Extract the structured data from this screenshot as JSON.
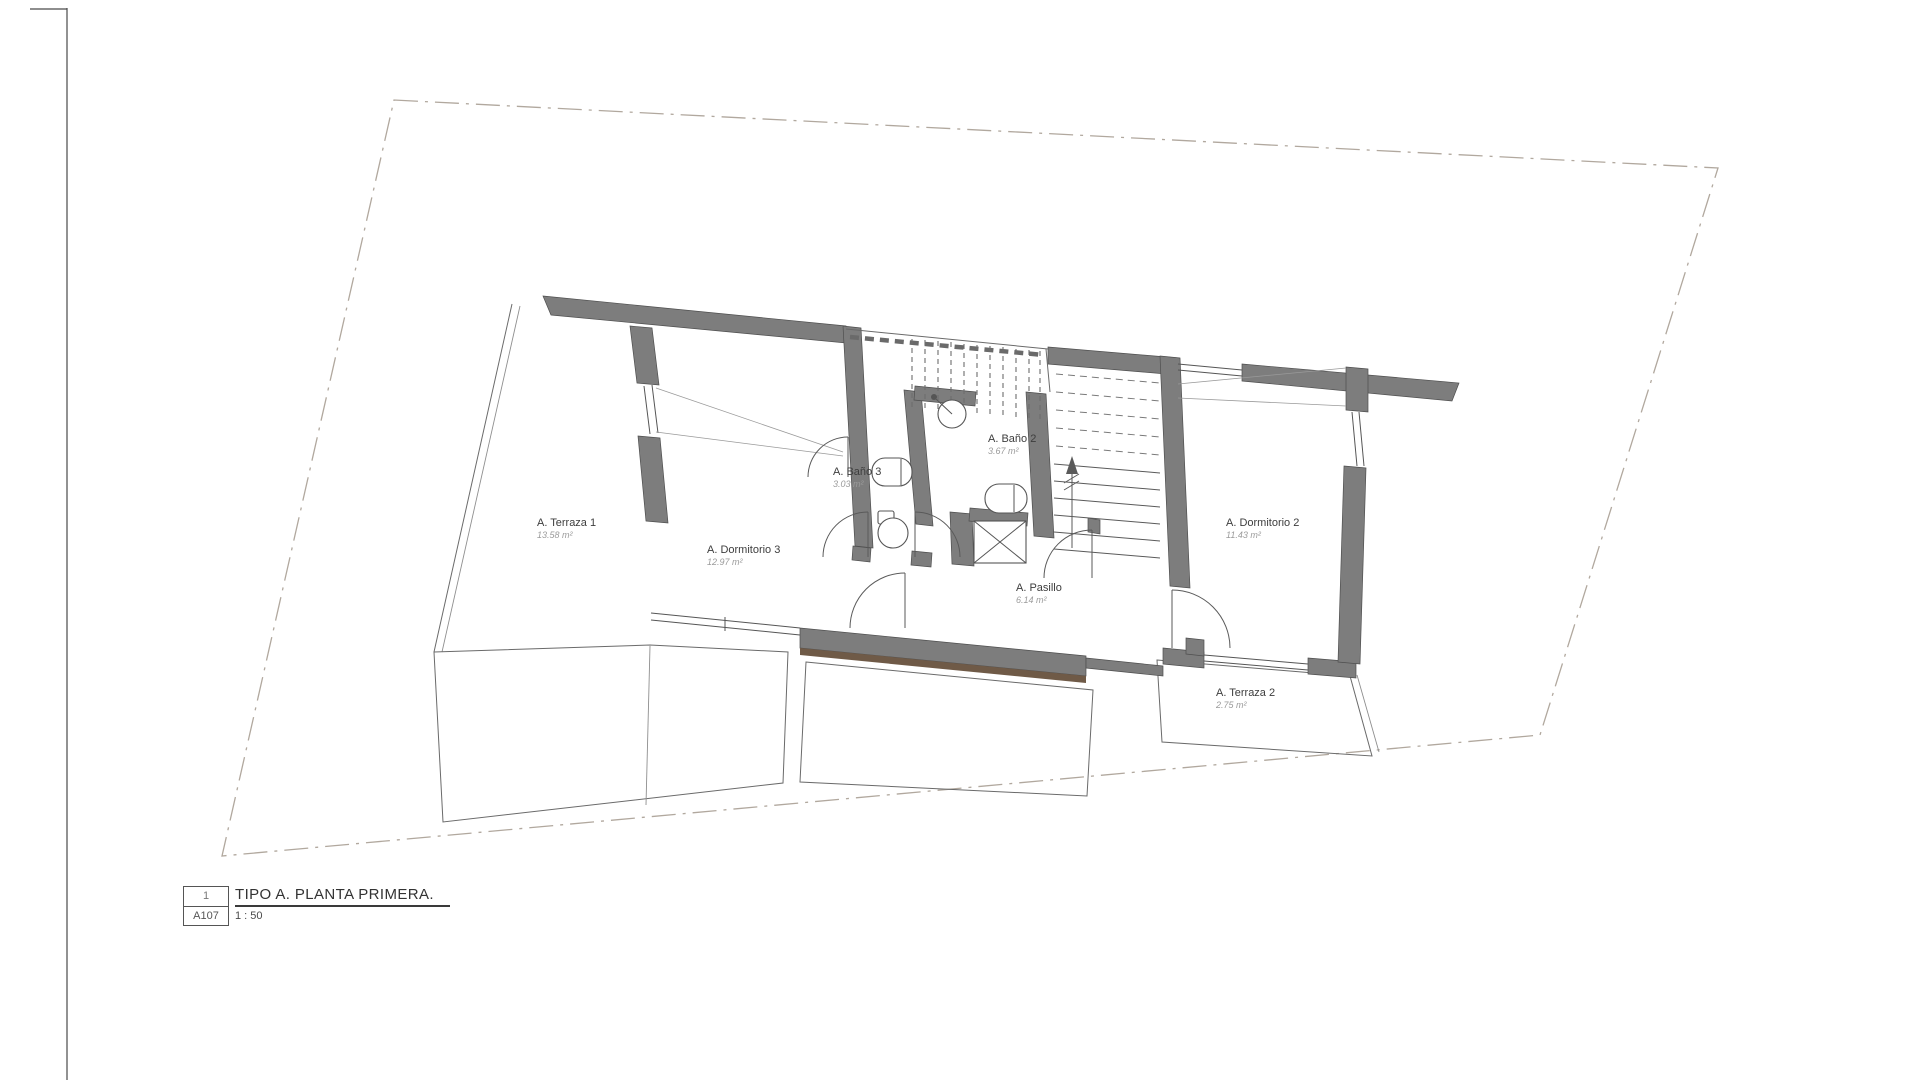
{
  "sheet": {
    "title_block": {
      "detail_number": "1",
      "sheet_number": "A107",
      "title": "TIPO A. PLANTA PRIMERA.",
      "scale": "1 : 50"
    },
    "rooms": [
      {
        "id": "terraza1",
        "name": "A. Terraza 1",
        "area": "13.58 m²"
      },
      {
        "id": "dormitorio3",
        "name": "A. Dormitorio 3",
        "area": "12.97 m²"
      },
      {
        "id": "bano3",
        "name": "A. Baño 3",
        "area": "3.03 m²"
      },
      {
        "id": "bano2",
        "name": "A. Baño 2",
        "area": "3.67 m²"
      },
      {
        "id": "pasillo",
        "name": "A. Pasillo",
        "area": "6.14 m²"
      },
      {
        "id": "dormitorio2",
        "name": "A. Dormitorio 2",
        "area": "11.43 m²"
      },
      {
        "id": "terraza2",
        "name": "A. Terraza 2",
        "area": "2.75 m²"
      }
    ],
    "colors": {
      "wall": "#7d7d7d",
      "deck_edge": "#6f5a47",
      "line": "#555555",
      "boundary": "#b1a89e",
      "room_label": "#3d3d3d",
      "area_label": "#9b9b9b"
    }
  }
}
